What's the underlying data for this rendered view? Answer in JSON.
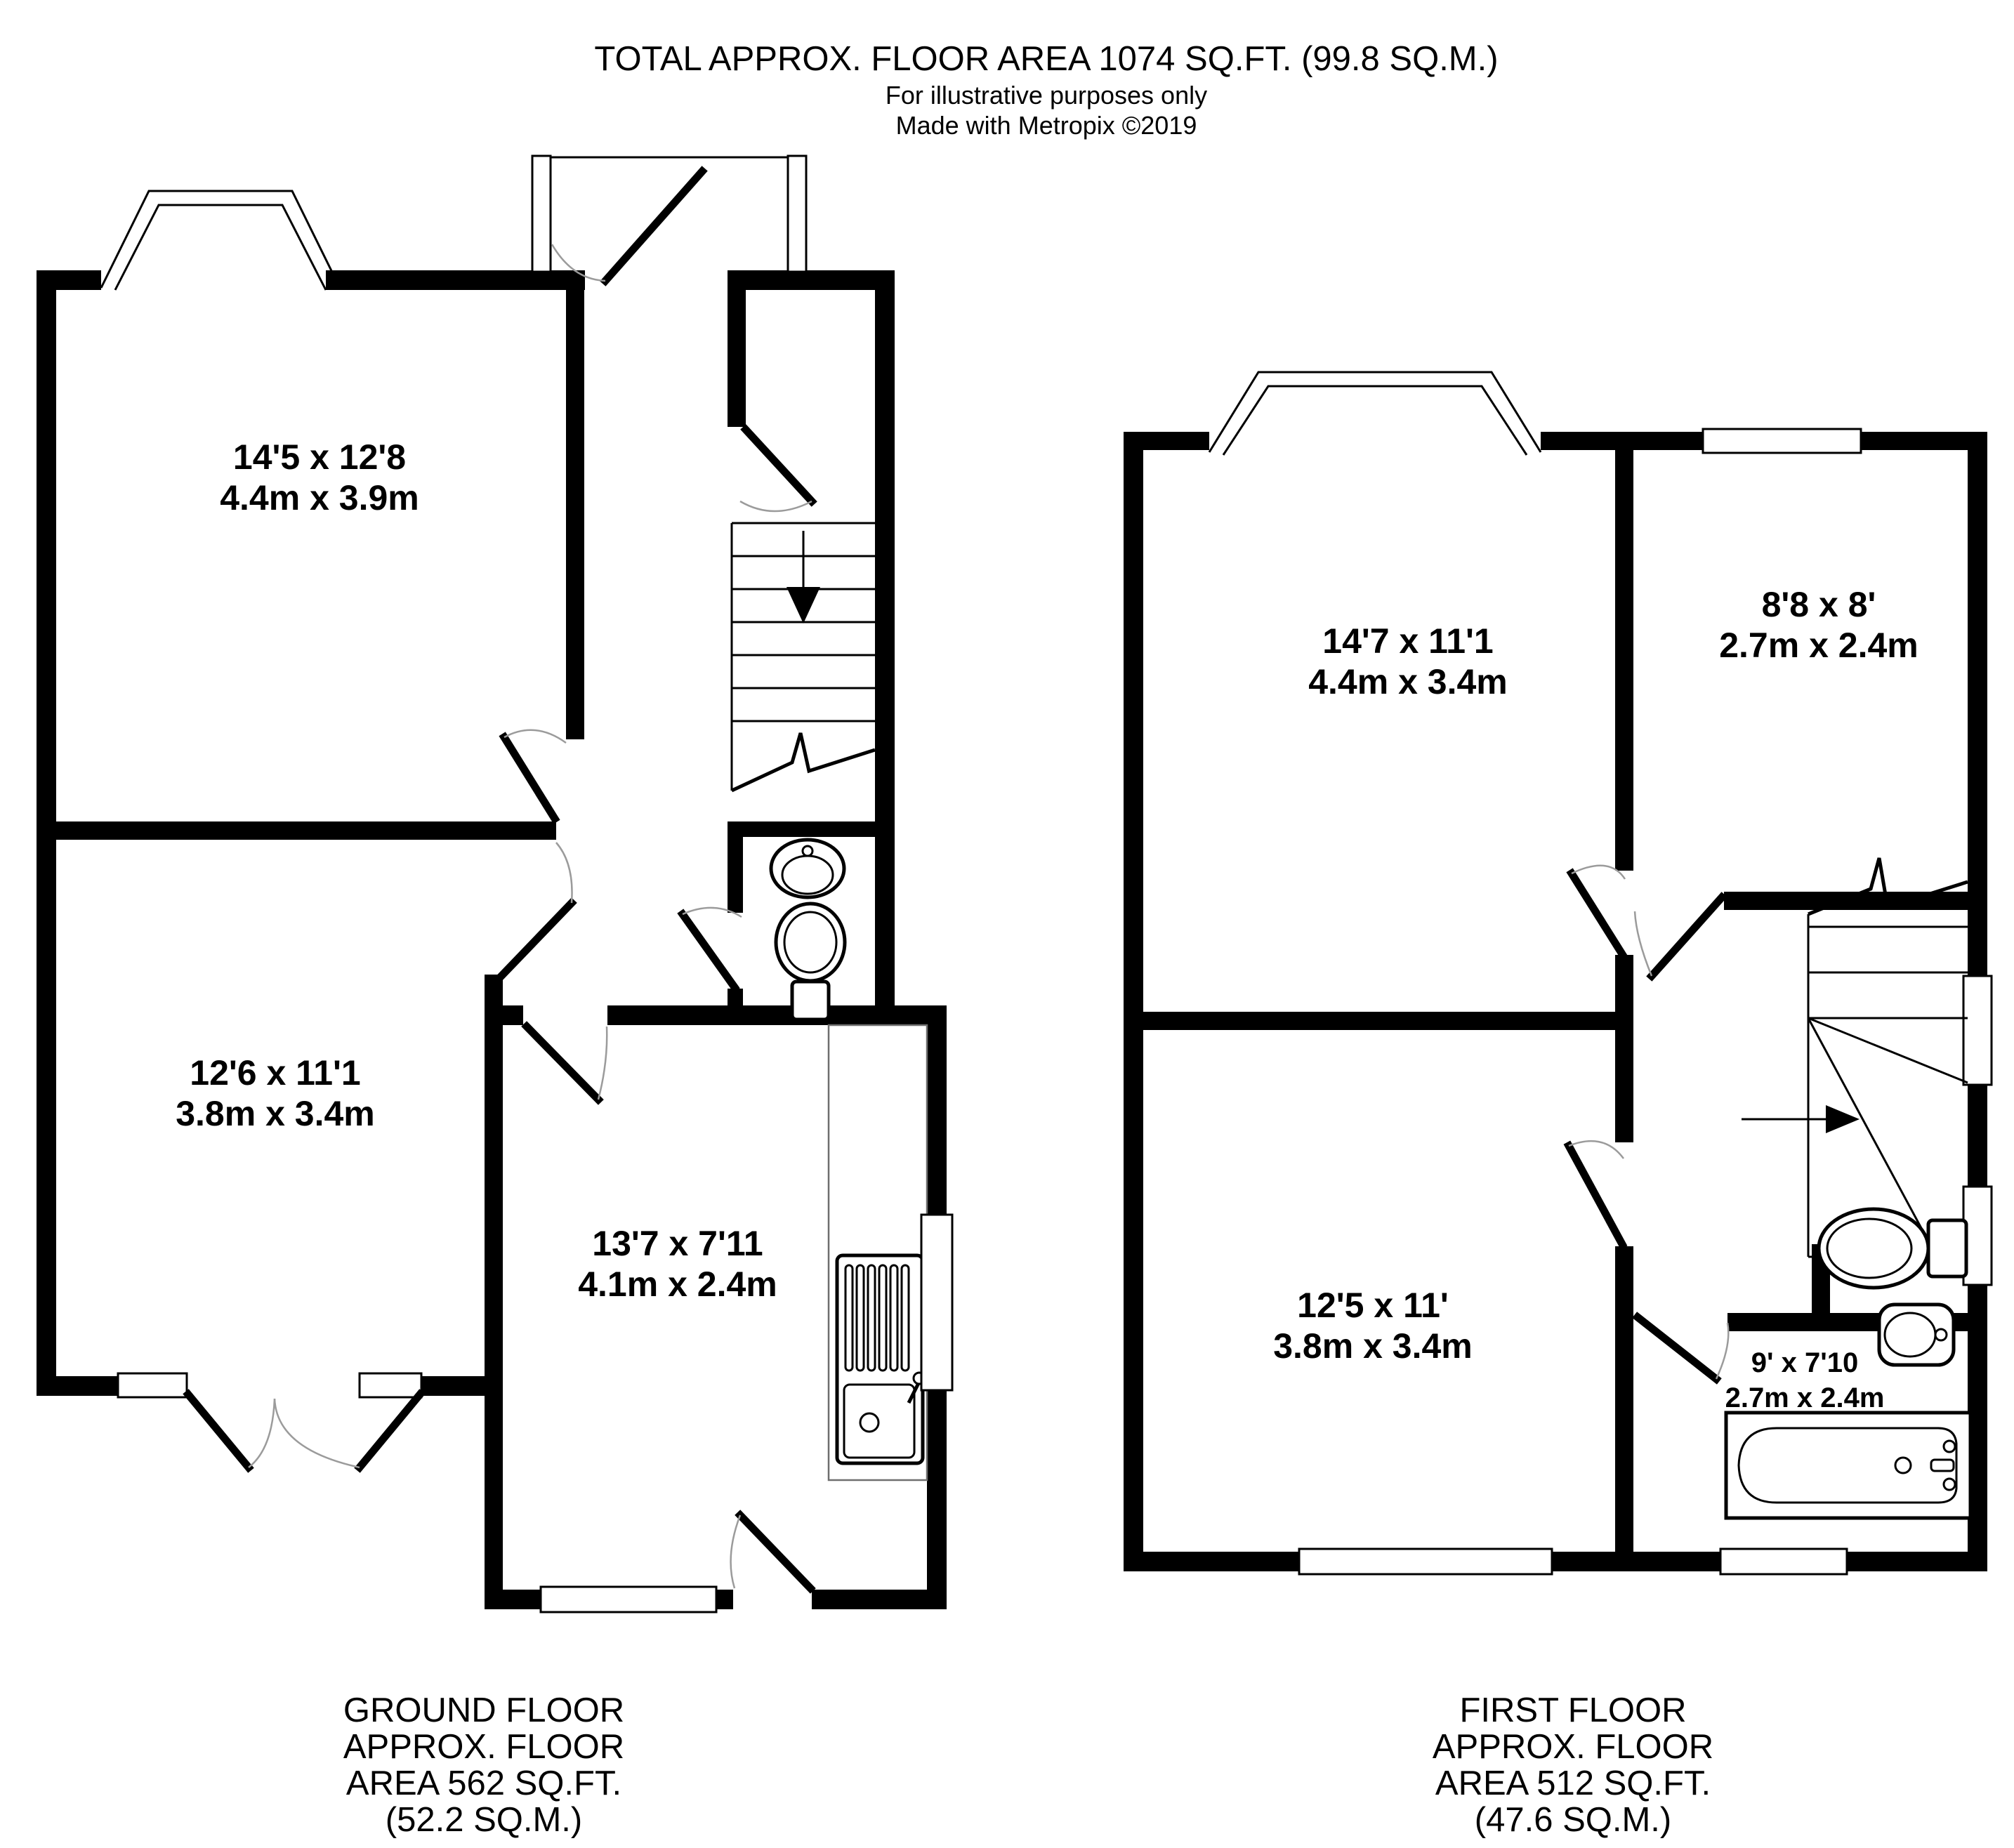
{
  "header": {
    "title": "TOTAL APPROX. FLOOR AREA 1074 SQ.FT. (99.8 SQ.M.)",
    "subtitle1": "For illustrative purposes only",
    "subtitle2": "Made with Metropix ©2019"
  },
  "floors": {
    "ground": {
      "caption": [
        "GROUND FLOOR",
        "APPROX. FLOOR",
        "AREA 562 SQ.FT.",
        "(52.2 SQ.M.)"
      ],
      "rooms": {
        "lounge": {
          "imperial": "14'5 x 12'8",
          "metric": "4.4m x 3.9m"
        },
        "dining": {
          "imperial": "12'6 x 11'1",
          "metric": "3.8m x 3.4m"
        },
        "kitchen": {
          "imperial": "13'7 x 7'11",
          "metric": "4.1m x 2.4m"
        }
      }
    },
    "first": {
      "caption": [
        "FIRST FLOOR",
        "APPROX. FLOOR",
        "AREA 512 SQ.FT.",
        "(47.6 SQ.M.)"
      ],
      "rooms": {
        "bedroom1": {
          "imperial": "14'7 x 11'1",
          "metric": "4.4m x 3.4m"
        },
        "bedroom2": {
          "imperial": "8'8 x 8'",
          "metric": "2.7m x 2.4m"
        },
        "bedroom3": {
          "imperial": "12'5 x 11'",
          "metric": "3.8m x 3.4m"
        },
        "bathroom": {
          "imperial": "9' x 7'10",
          "metric": "2.7m x 2.4m"
        }
      }
    }
  },
  "icons": [
    "stairs-icon",
    "down-arrow-icon",
    "right-arrow-icon",
    "toilet-icon",
    "sink-icon",
    "kitchen-sink-icon",
    "bath-icon",
    "door-leaf-icon",
    "window-icon",
    "bay-window-icon"
  ],
  "colors": {
    "wall": "#000000",
    "background": "#ffffff",
    "door_arc": "#9b9b9b",
    "counter_outline": "#6e6e6e"
  }
}
